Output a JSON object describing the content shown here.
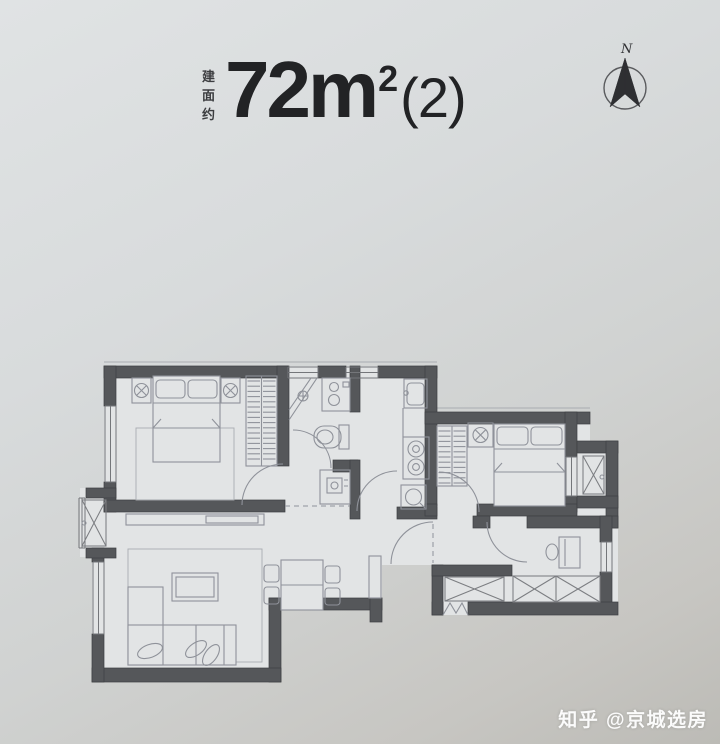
{
  "header": {
    "area_label_chars": [
      "建",
      "面",
      "约"
    ],
    "area_value": "72",
    "area_unit": "m",
    "area_sup": "2",
    "area_suffix": "(2)"
  },
  "compass": {
    "label": "N"
  },
  "watermark": {
    "text": "知乎 @京城选房"
  },
  "colors": {
    "background": "#d6d9da",
    "wall": "#55575a",
    "floor": "#e2e4e5",
    "line": "#8f929a",
    "line_light": "#a9acb1",
    "window": "#74767a",
    "title": "#222325",
    "watermark": "#ffffff"
  }
}
